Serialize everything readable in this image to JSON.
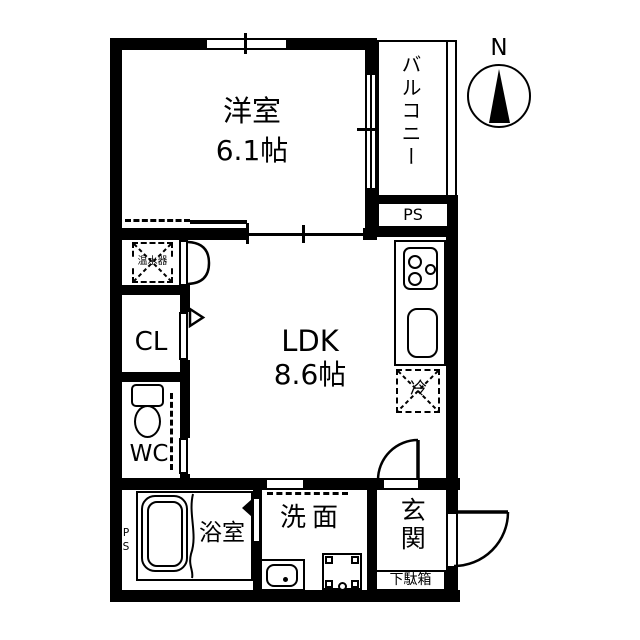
{
  "floor_plan": {
    "rooms": {
      "western_room": {
        "name": "洋室",
        "size": "6.1帖"
      },
      "ldk": {
        "name": "LDK",
        "size": "8.6帖"
      },
      "balcony": {
        "name": "バルコニー"
      },
      "closet": {
        "name": "CL"
      },
      "toilet": {
        "name": "WC"
      },
      "bathroom": {
        "name": "浴室"
      },
      "washroom": {
        "name": "洗面"
      },
      "entrance": {
        "name": "玄関"
      }
    },
    "labels": {
      "pipe_space_top": "PS",
      "pipe_space_bath": "PS",
      "water_heater": "温水器",
      "refrigerator": "冷",
      "shoe_cabinet": "下駄箱",
      "compass_north": "N"
    },
    "colors": {
      "wall": "#000000",
      "background": "#ffffff",
      "line": "#000000"
    }
  }
}
